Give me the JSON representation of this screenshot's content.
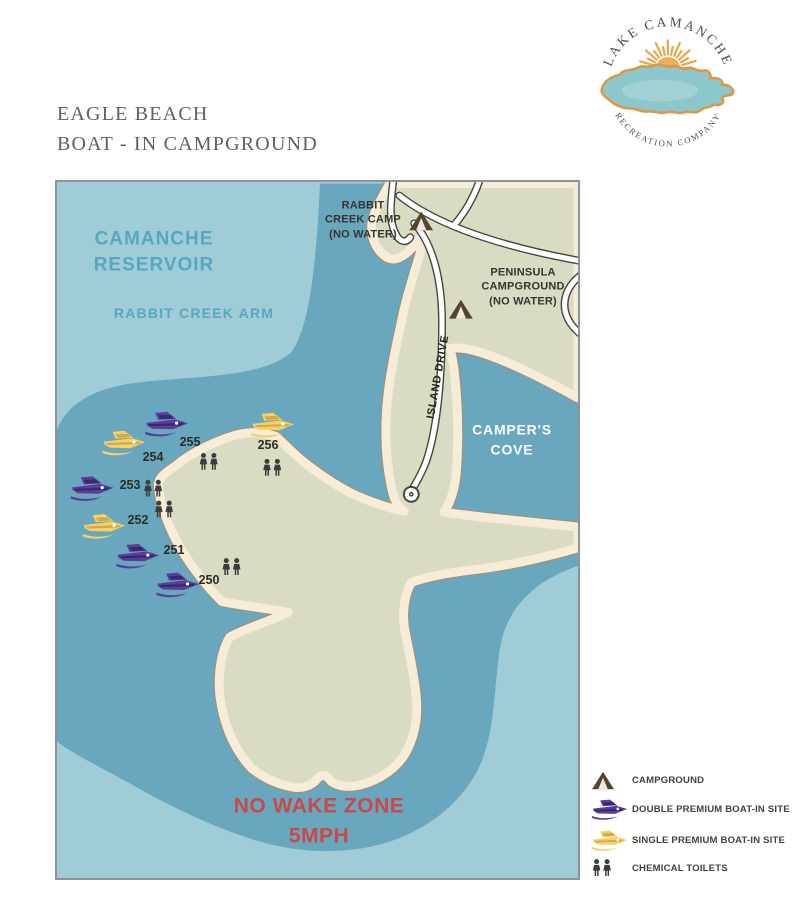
{
  "page": {
    "title_line1": "EAGLE BEACH",
    "title_line2": "BOAT - IN CAMPGROUND"
  },
  "logo": {
    "arc_top": "LAKE CAMANCHE",
    "arc_bottom": "RECREATION COMPANY"
  },
  "map": {
    "reservoir": [
      "CAMANCHE",
      "RESERVOIR"
    ],
    "rabbit_creek_arm": "RABBIT CREEK ARM",
    "rabbit_camp": [
      "RABBIT",
      "CREEK CAMP",
      "(NO WATER)"
    ],
    "peninsula_camp": [
      "PENINSULA",
      "CAMPGROUND",
      "(NO WATER)"
    ],
    "campers_cove": [
      "CAMPER'S",
      "COVE"
    ],
    "island_drive": "ISLAND DRIVE",
    "no_wake": [
      "NO WAKE ZONE",
      "5MPH"
    ],
    "sites": [
      {
        "number": "250",
        "x": 152,
        "y": 398,
        "toilet": {
          "x": 176,
          "y": 386
        }
      },
      {
        "number": "251",
        "x": 117,
        "y": 368,
        "toilet": null
      },
      {
        "number": "252",
        "x": 81,
        "y": 338,
        "toilet": {
          "x": 108,
          "y": 328
        }
      },
      {
        "number": "253",
        "x": 73,
        "y": 303,
        "toilet": {
          "x": 97,
          "y": 307
        }
      },
      {
        "number": "254",
        "x": 96,
        "y": 275,
        "toilet": null
      },
      {
        "number": "255",
        "x": 133,
        "y": 260,
        "toilet": {
          "x": 153,
          "y": 280
        }
      },
      {
        "number": "256",
        "x": 211,
        "y": 263,
        "toilet": {
          "x": 217,
          "y": 286
        }
      }
    ],
    "boats": [
      {
        "type": "double",
        "x": 111,
        "y": 241
      },
      {
        "type": "single",
        "x": 68,
        "y": 260
      },
      {
        "type": "single",
        "x": 218,
        "y": 242
      },
      {
        "type": "double",
        "x": 36,
        "y": 306
      },
      {
        "type": "single",
        "x": 48,
        "y": 344
      },
      {
        "type": "double",
        "x": 82,
        "y": 374
      },
      {
        "type": "double",
        "x": 122,
        "y": 403
      }
    ],
    "tents": [
      {
        "x": 367,
        "y": 37
      },
      {
        "x": 407,
        "y": 126
      }
    ]
  },
  "legend": {
    "items": [
      {
        "icon": "campground-icon",
        "icon_ref": "#icon-tent",
        "label": "CAMPGROUND"
      },
      {
        "icon": "double-premium-boat-icon",
        "icon_ref": "#icon-boat-double",
        "label": "DOUBLE PREMIUM BOAT-IN SITE"
      },
      {
        "icon": "single-premium-boat-icon",
        "icon_ref": "#icon-boat-single",
        "label": "SINGLE PREMIUM BOAT-IN SITE"
      },
      {
        "icon": "chemical-toilets-icon",
        "icon_ref": "#icon-toilets",
        "label": "CHEMICAL TOILETS"
      }
    ]
  },
  "colors": {
    "water_light": "#9fccd6",
    "water_dark": "#68a7bd",
    "land": "#d9dcc3",
    "sand": "#f6ecd7",
    "double_boat": "#5a3d99",
    "double_boat_dark": "#38286e",
    "single_boat": "#f3d26b",
    "single_boat_dark": "#d8a93f",
    "no_wake_red": "#cb4848",
    "label_blue": "#58a7c2",
    "sun_gold": "#e8a64f",
    "lake_teal": "#8cc7cb"
  }
}
